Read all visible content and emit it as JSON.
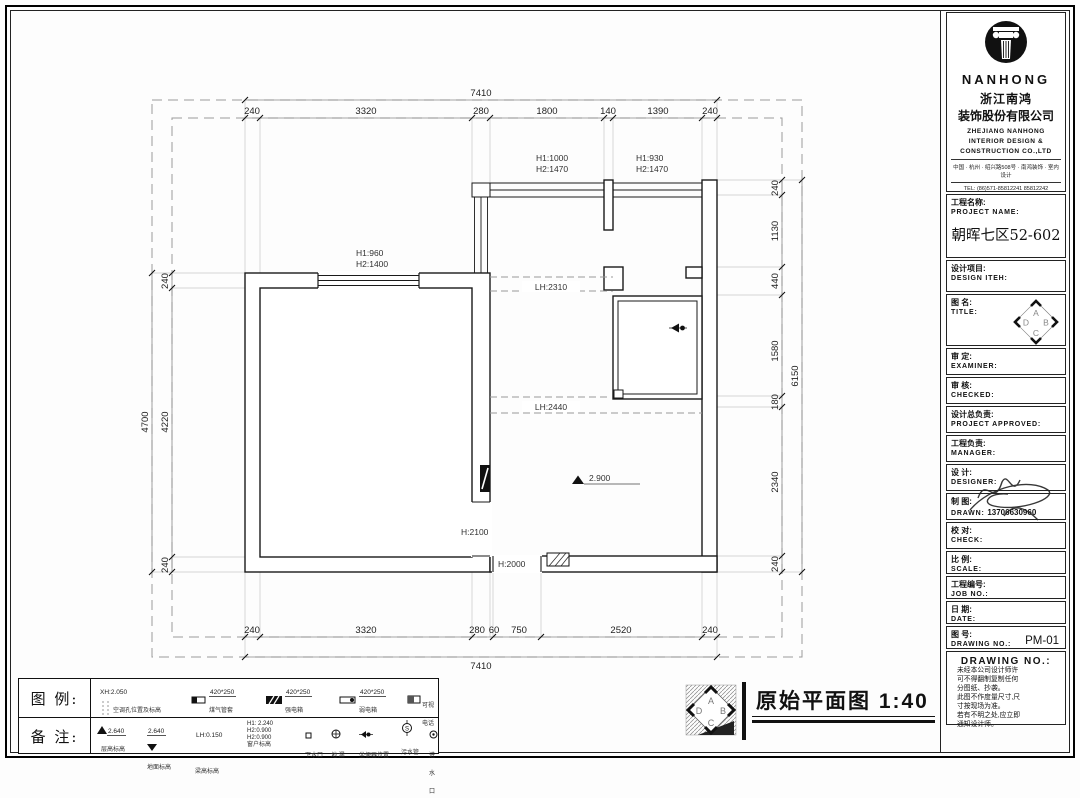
{
  "logo": {
    "brand": "NANHONG",
    "company_cn_1": "浙江南鸿",
    "company_cn_2": "装饰股份有限公司",
    "company_en_1": "ZHEJIANG NANHONG",
    "company_en_2": "INTERIOR DESIGN &",
    "company_en_3": "CONSTRUCTION CO.,LTD",
    "address": "中国 · 杭州 · 绍兴路508号 · 南鸿装饰 · 室内设计",
    "tel": "TEL:  (86)571-85812241  85812242",
    "letters": [
      "A",
      "B",
      "C",
      "D"
    ]
  },
  "fields": [
    {
      "cn": "工程名称:",
      "en": "PROJECT NAME:",
      "value": "朝晖七区52-602"
    },
    {
      "cn": "设计项目:",
      "en": "DESIGN ITEH:",
      "value": ""
    },
    {
      "cn": "图  名:",
      "en": "TITLE:",
      "value": ""
    },
    {
      "cn": "审  定:",
      "en": "EXAMINER:",
      "value": ""
    },
    {
      "cn": "审  核:",
      "en": "CHECKED:",
      "value": ""
    },
    {
      "cn": "设计总负责:",
      "en": "PROJECT APPROVED:",
      "value": ""
    },
    {
      "cn": "工程负责:",
      "en": "MANAGER:",
      "value": ""
    },
    {
      "cn": "设  计:",
      "en": "DESIGNER:",
      "value": ""
    },
    {
      "cn": "制  图:",
      "en": "DRAWN:",
      "value": "13706630960"
    },
    {
      "cn": "校  对:",
      "en": "CHECK:",
      "value": ""
    },
    {
      "cn": "比  例:",
      "en": "SCALE:",
      "value": ""
    },
    {
      "cn": "工程编号:",
      "en": "JOB NO.:",
      "value": ""
    },
    {
      "cn": "日  期:",
      "en": "DATE:",
      "value": ""
    },
    {
      "cn": "图  号:",
      "en": "DRAWING NO.:",
      "value": "PM-01"
    }
  ],
  "notes": {
    "header": "DRAWING NO.:",
    "lines": [
      "未经本公司设计师许",
      "可不得翻制复制任何",
      "分图纸、抄袭。",
      "此图不作度量尺寸,尺",
      "寸按现场为准。",
      "若有不明之处,应立即",
      "通知设计师。"
    ]
  },
  "plan": {
    "overall_top": "7410",
    "overall_bottom": "7410",
    "overall_left": "4700",
    "overall_right": "6150",
    "top": [
      "240",
      "3320",
      "280",
      "1800",
      "140",
      "1390",
      "240"
    ],
    "bottom": [
      "240",
      "3320",
      "280",
      "60",
      "750",
      "2520",
      "240"
    ],
    "left": [
      "240",
      "4220",
      "240"
    ],
    "right": [
      "240",
      "1130",
      "440",
      "1580",
      "180",
      "2340",
      "240"
    ],
    "labels": {
      "win_left_1": "H1:960",
      "win_left_2": "H2:1400",
      "win_mid_1": "H1:1000",
      "win_mid_2": "H2:1470",
      "win_right_1": "H1:930",
      "win_right_2": "H2:1470",
      "beam_1": "LH:2310",
      "beam_2": "LH:2440",
      "door": "H:2100",
      "opening": "H:2000",
      "elev": "2.900"
    }
  },
  "legend": {
    "header_1": "图 例:",
    "header_2": "备 注:",
    "row1": [
      {
        "value": "XH:2.050",
        "label": "空调孔位置及标高"
      },
      {
        "value": "420*250",
        "label": "煤气管套"
      },
      {
        "value": "420*250",
        "label": "强电箱"
      },
      {
        "value": "420*250",
        "label": "弱电箱"
      },
      {
        "value": "",
        "label": "可视电话"
      }
    ],
    "row2": [
      {
        "value": "2.640",
        "label": "层高标高"
      },
      {
        "value": "2.640",
        "label": "地面标高"
      },
      {
        "value": "LH:0.150",
        "label": "梁高标高"
      },
      {
        "value": "H1: 2.240",
        "value2": "H2:0.900",
        "value3": "H2:0.900",
        "label": "窗户标高"
      },
      {
        "value": "",
        "label": "下水口"
      },
      {
        "value": "",
        "label": "地 漏"
      },
      {
        "value": "",
        "label": "坐便器位置"
      },
      {
        "value": "",
        "label": "污水管"
      },
      {
        "value": "",
        "label": "进水口"
      }
    ]
  },
  "footer": {
    "title": "原始平面图 1:40"
  }
}
